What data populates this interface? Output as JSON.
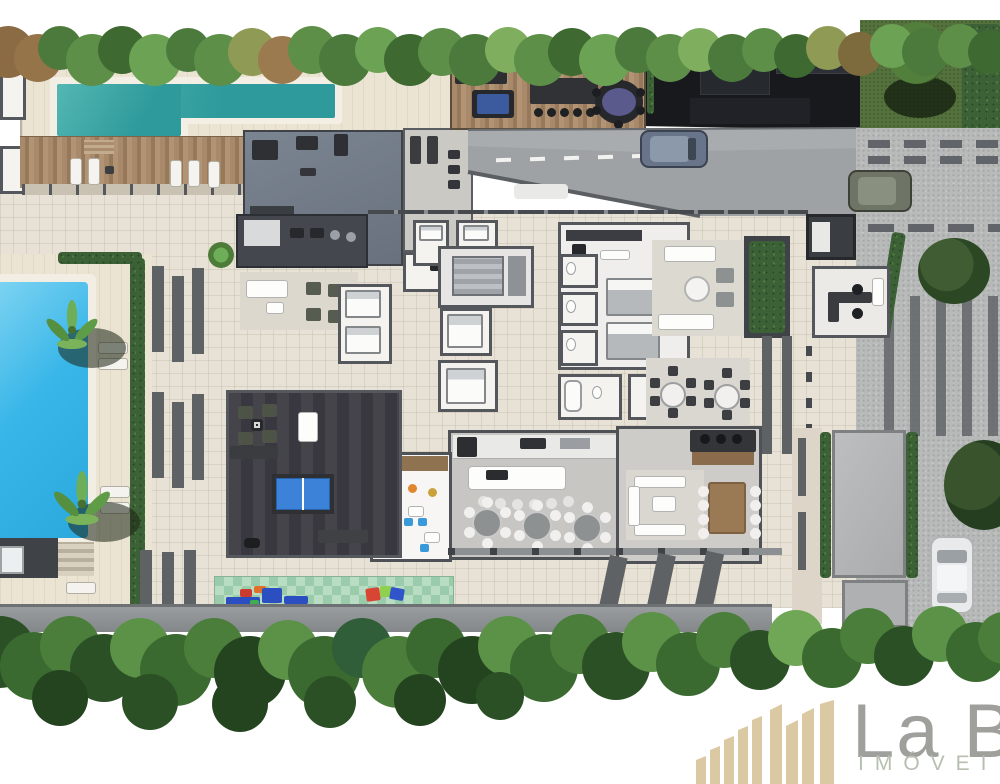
{
  "watermark": {
    "brand": "La B",
    "tagline": "IMÓVEI"
  },
  "palette": {
    "lap_pool_teal": "#2f9b9c",
    "main_pool_blue": "#38b6e8",
    "deck_cream": "#ece4d2",
    "wood_deck_brown": "#a8896a",
    "plan_tile_beige": "#e8e2d6",
    "dark_roof_charcoal": "#17191d",
    "gym_floor_slate": "#747e8a",
    "game_room_floor": "#3f3e45",
    "pingpong_table_blue": "#3b82d8",
    "billiards_felt_blue": "#3b5b9e",
    "poker_table_purple": "#5a5a8c",
    "hedge_green": "#3c6136",
    "tree_green": "#4c7a3c",
    "playground_mat_green": "#a9d4b4",
    "cobblestone_gray": "#b7bab9",
    "road_gray": "#9ea2a4",
    "logo_bars_beige": "#dac9a2",
    "logo_text_gray": "#9f9f9c",
    "logo_tagline_sage": "#b6bfb0"
  }
}
